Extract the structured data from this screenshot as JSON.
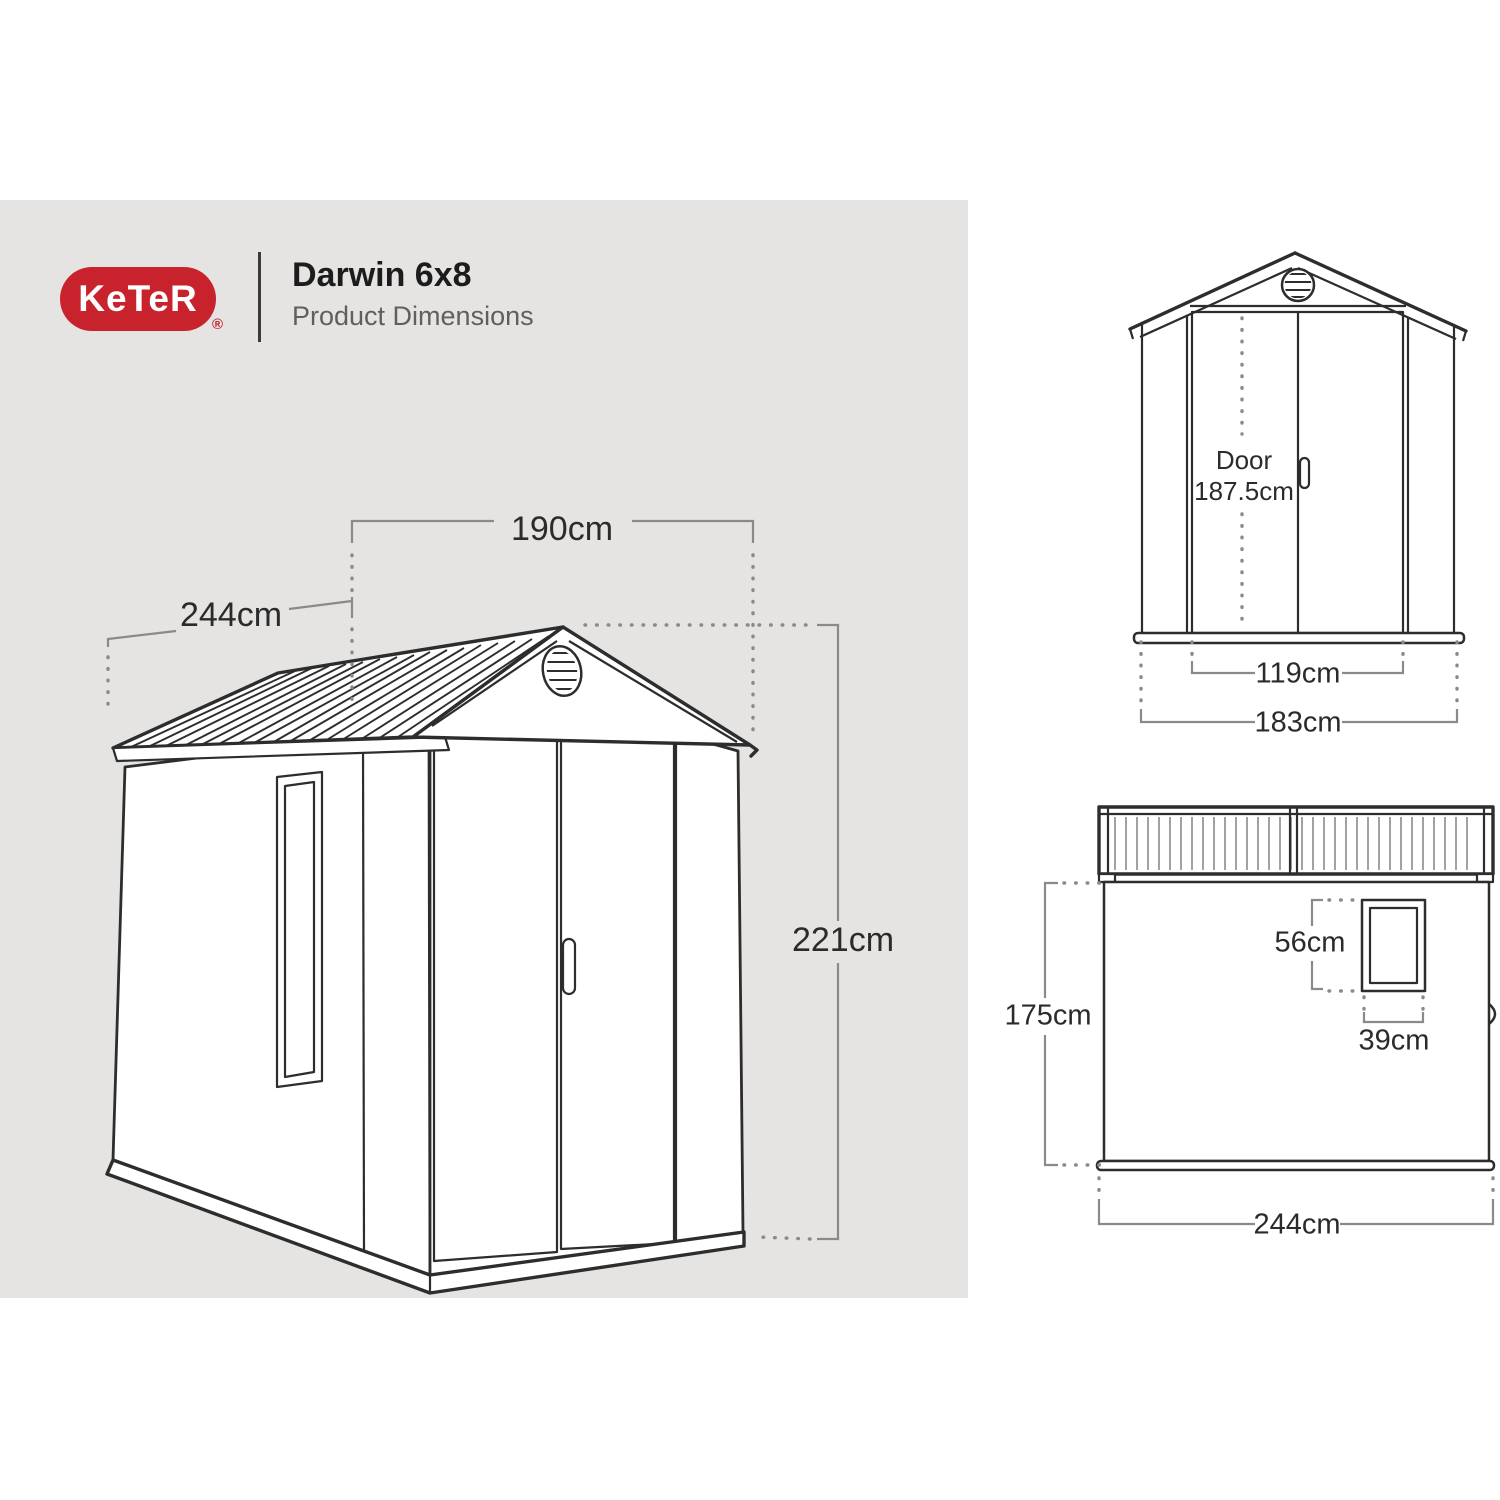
{
  "header": {
    "brand": "KeTeR",
    "registered_mark": "®",
    "title": "Darwin 6x8",
    "subtitle": "Product Dimensions"
  },
  "colors": {
    "panel_bg": "#e5e4e2",
    "brand_red": "#c8232c",
    "line_dark": "#2d2d2d",
    "dim_line": "#8a8a8a",
    "text_dark": "#2b2b2b",
    "subtitle": "#5f5f5f"
  },
  "iso_view": {
    "width_label": "190cm",
    "depth_label": "244cm",
    "height_label": "221cm"
  },
  "front_view": {
    "door_label": "Door",
    "door_height_label": "187.5cm",
    "door_width_label": "119cm",
    "overall_width_label": "183cm"
  },
  "side_view": {
    "height_label": "175cm",
    "window_height_label": "56cm",
    "window_width_label": "39cm",
    "depth_label": "244cm"
  }
}
